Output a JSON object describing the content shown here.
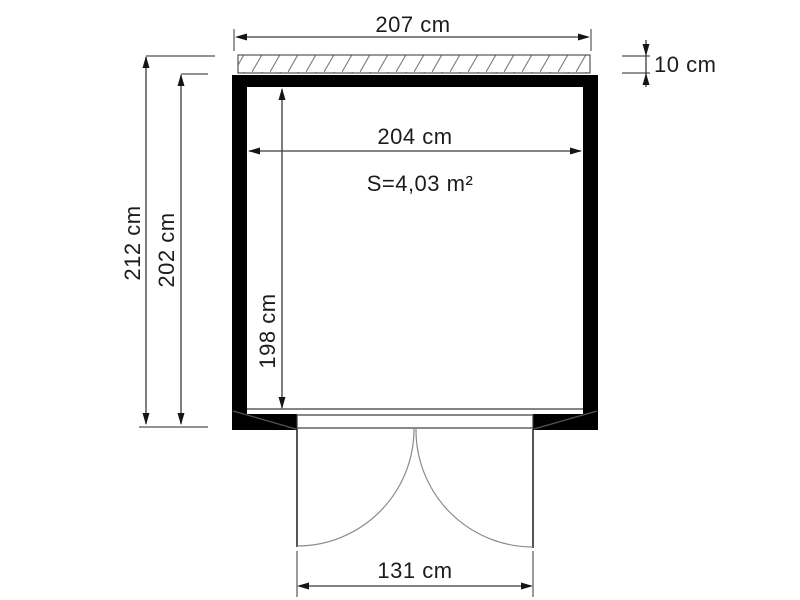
{
  "drawing": {
    "name": "garden-shed-floor-plan",
    "labels": {
      "roof_width": "207 cm",
      "roof_overhang_depth": "10 cm",
      "inner_width": "204 cm",
      "floor_area": "S=4,03 m²",
      "outer_height_with_roof": "212 cm",
      "outer_wall_height": "202 cm",
      "inner_depth": "198 cm",
      "door_opening_width": "131 cm"
    },
    "colors": {
      "background": "#ffffff",
      "wall_fill": "#000000",
      "dim_line": "#3a3a3a",
      "ext_line": "#6e6e6e",
      "hatch_line": "#7a7a7a",
      "swing_arc": "#8a8a8a",
      "text": "#1c1c1c"
    }
  }
}
